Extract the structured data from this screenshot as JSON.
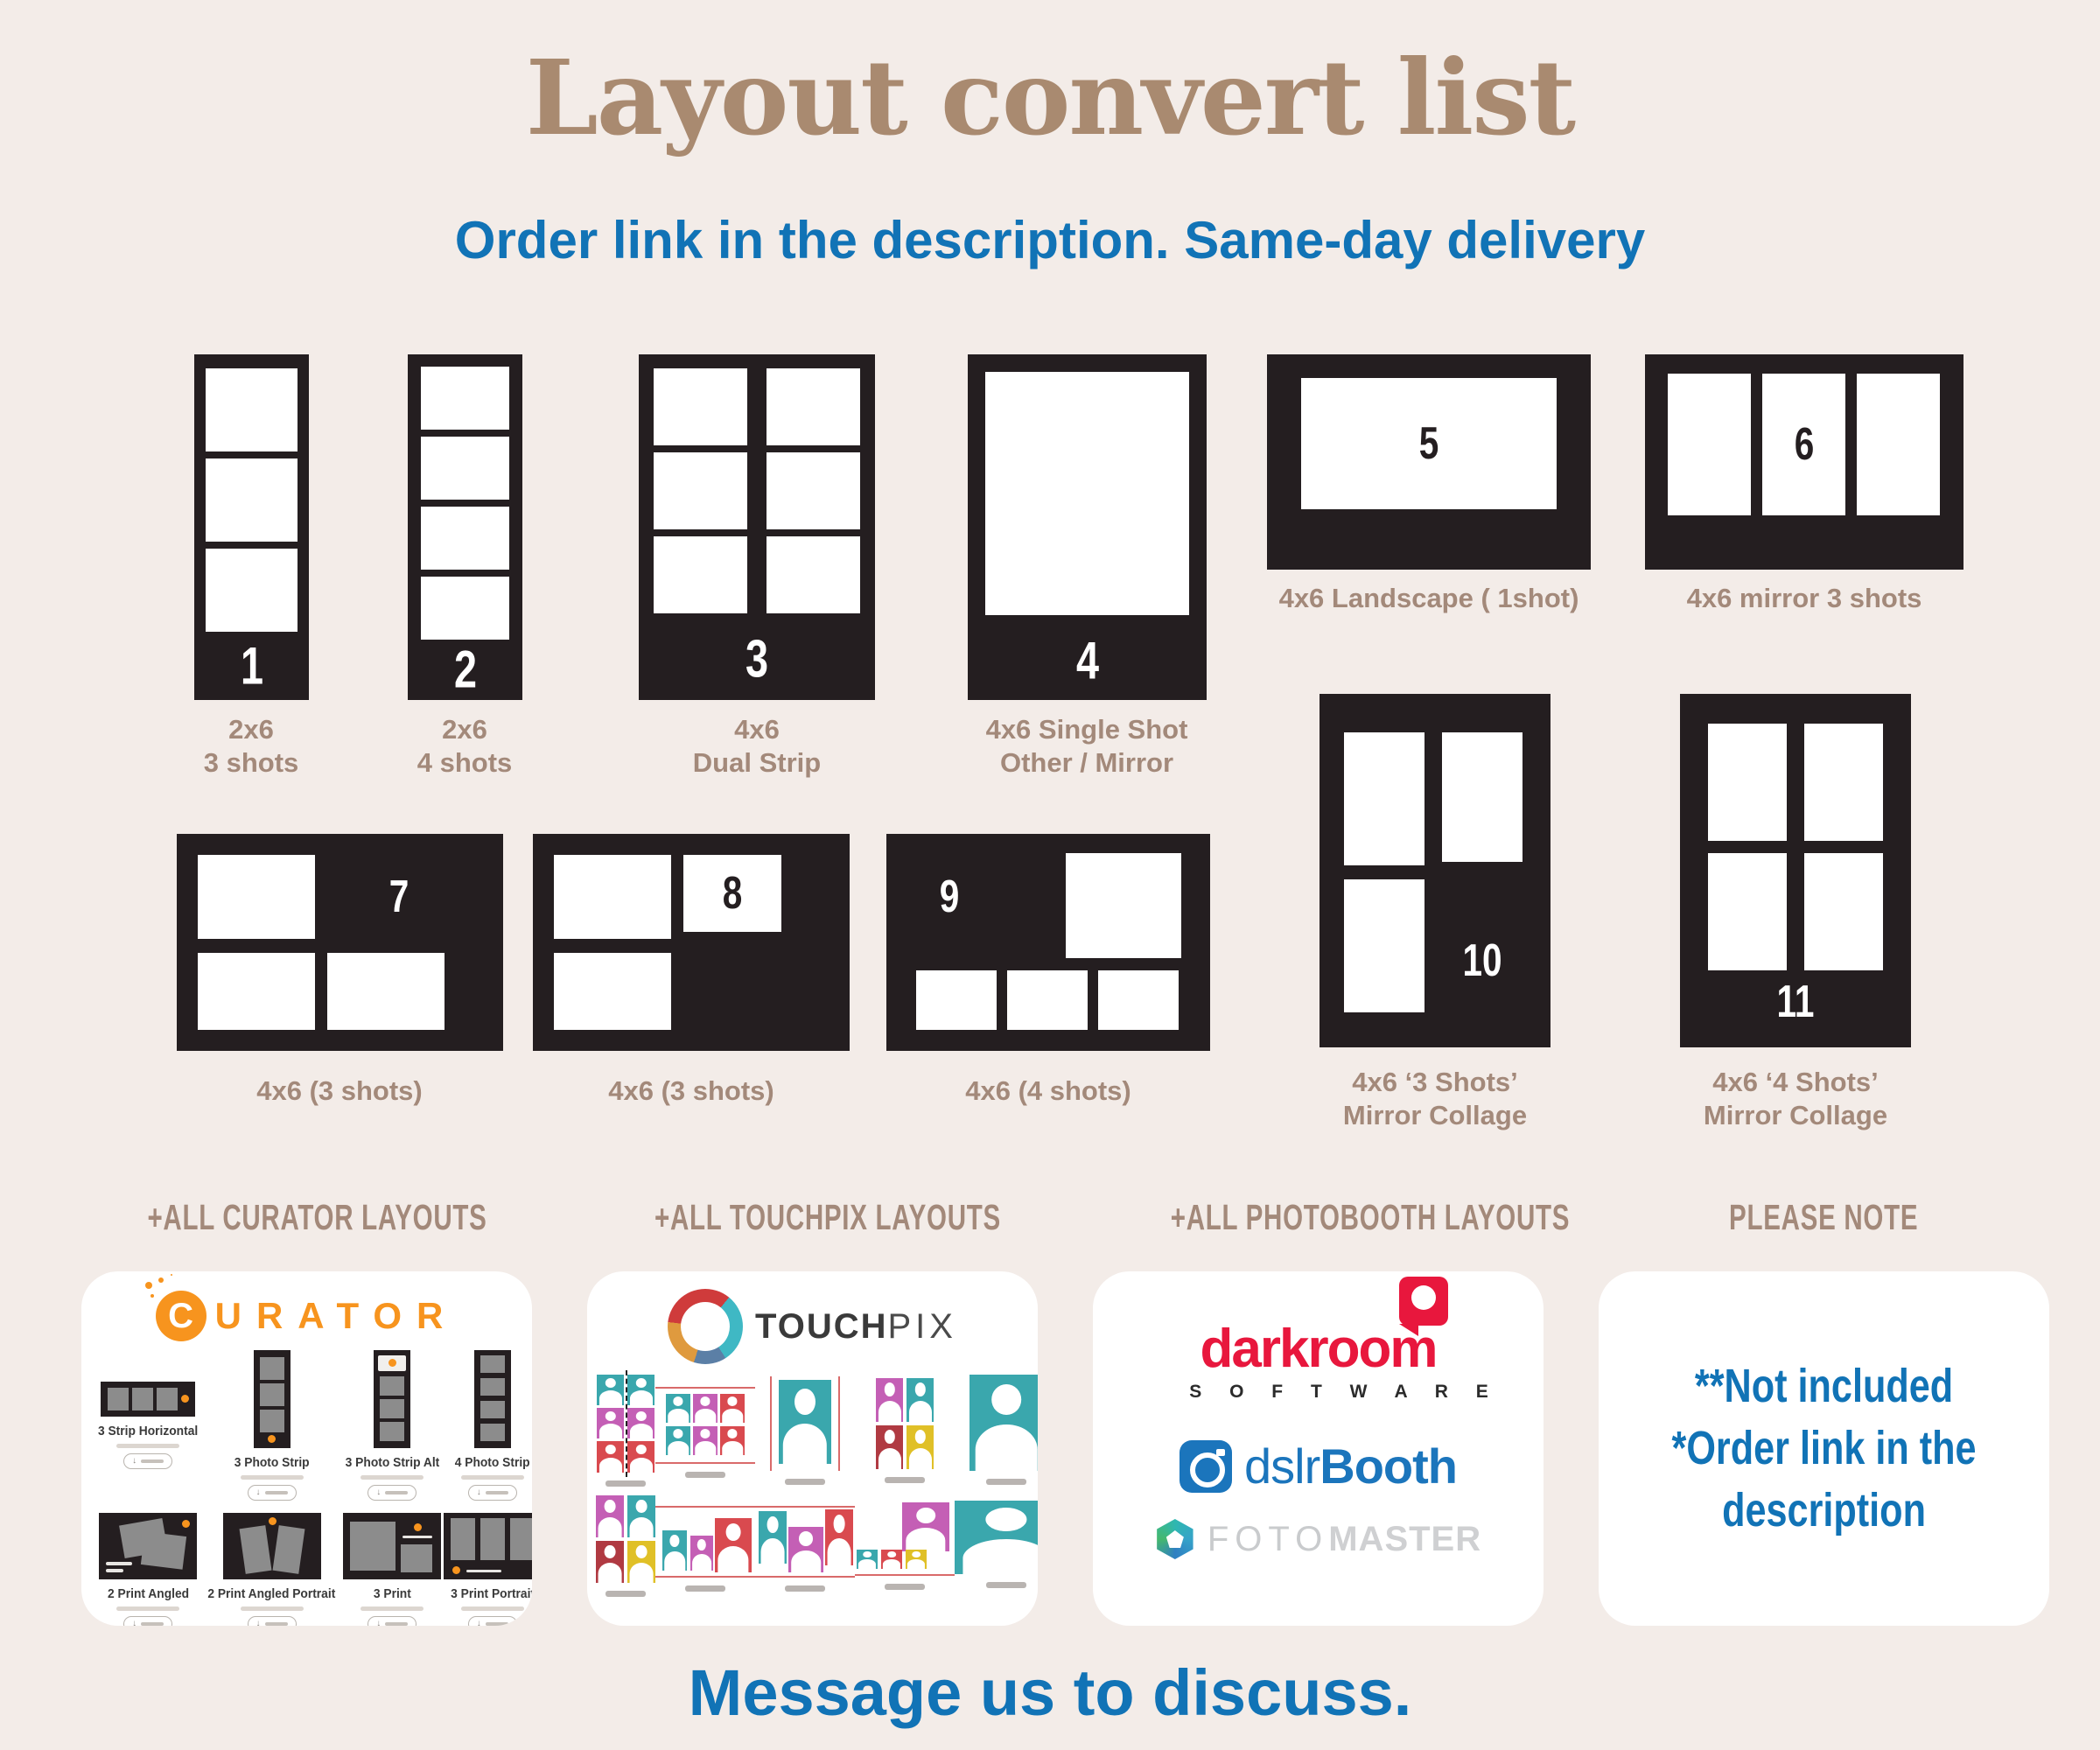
{
  "page": {
    "title": "Layout convert list",
    "subtitle": "Order link in the description. Same-day delivery",
    "footer": "Message us to discuss."
  },
  "colors": {
    "background": "#f3ece8",
    "card_dark": "#241e20",
    "title_brown": "#a98a70",
    "label_brown": "#a3897a",
    "accent_blue": "#1173b6",
    "curator_orange": "#f7941e",
    "darkroom_red": "#e8173d",
    "dslrbooth_blue": "#1b75bc",
    "fotomaster_teal": "#2fb7b0",
    "touchpix_teal": "#3aa7ad",
    "touchpix_magenta": "#c45fb5",
    "touchpix_red": "#d94a4f",
    "touchpix_yellow": "#e0c027"
  },
  "layouts": [
    {
      "num": "1",
      "label": "2x6\n3 shots"
    },
    {
      "num": "2",
      "label": "2x6\n4 shots"
    },
    {
      "num": "3",
      "label": "4x6\nDual Strip"
    },
    {
      "num": "4",
      "label": "4x6 Single Shot\nOther / Mirror"
    },
    {
      "num": "5",
      "label": "4x6 Landscape ( 1shot)"
    },
    {
      "num": "6",
      "label": "4x6 mirror 3 shots"
    },
    {
      "num": "7",
      "label": "4x6 (3 shots)"
    },
    {
      "num": "8",
      "label": "4x6 (3 shots)"
    },
    {
      "num": "9",
      "label": "4x6 (4 shots)"
    },
    {
      "num": "10",
      "label": "4x6 ‘3 Shots’\nMirror Collage"
    },
    {
      "num": "11",
      "label": "4x6 ‘4 Shots’\nMirror Collage"
    }
  ],
  "sections": {
    "curator": "+ALL CURATOR LAYOUTS",
    "touchpix": "+ALL TOUCHPIX LAYOUTS",
    "photobooth": "+ALL PHOTOBOOTH LAYOUTS",
    "note": "PLEASE NOTE"
  },
  "curator": {
    "brand_initial": "C",
    "brand_rest": "URATOR",
    "items": [
      {
        "label": "3 Strip Horizontal"
      },
      {
        "label": "3 Photo Strip"
      },
      {
        "label": "3 Photo Strip Alt"
      },
      {
        "label": "4 Photo Strip"
      },
      {
        "label": "2 Print Angled"
      },
      {
        "label": "2 Print Angled Portrait"
      },
      {
        "label": "3 Print"
      },
      {
        "label": "3 Print Portrait"
      }
    ]
  },
  "touchpix": {
    "brand_bold": "TOUCH",
    "brand_light": "PIX"
  },
  "photobooth": {
    "darkroom": "darkroom",
    "software": "S O F T W A R E",
    "dslr_light": "dslr",
    "dslr_bold": "Booth",
    "foto_light": "FOTO",
    "foto_bold": "MASTER"
  },
  "note": {
    "text": "**Not included\n*Order link in the\ndescription"
  }
}
